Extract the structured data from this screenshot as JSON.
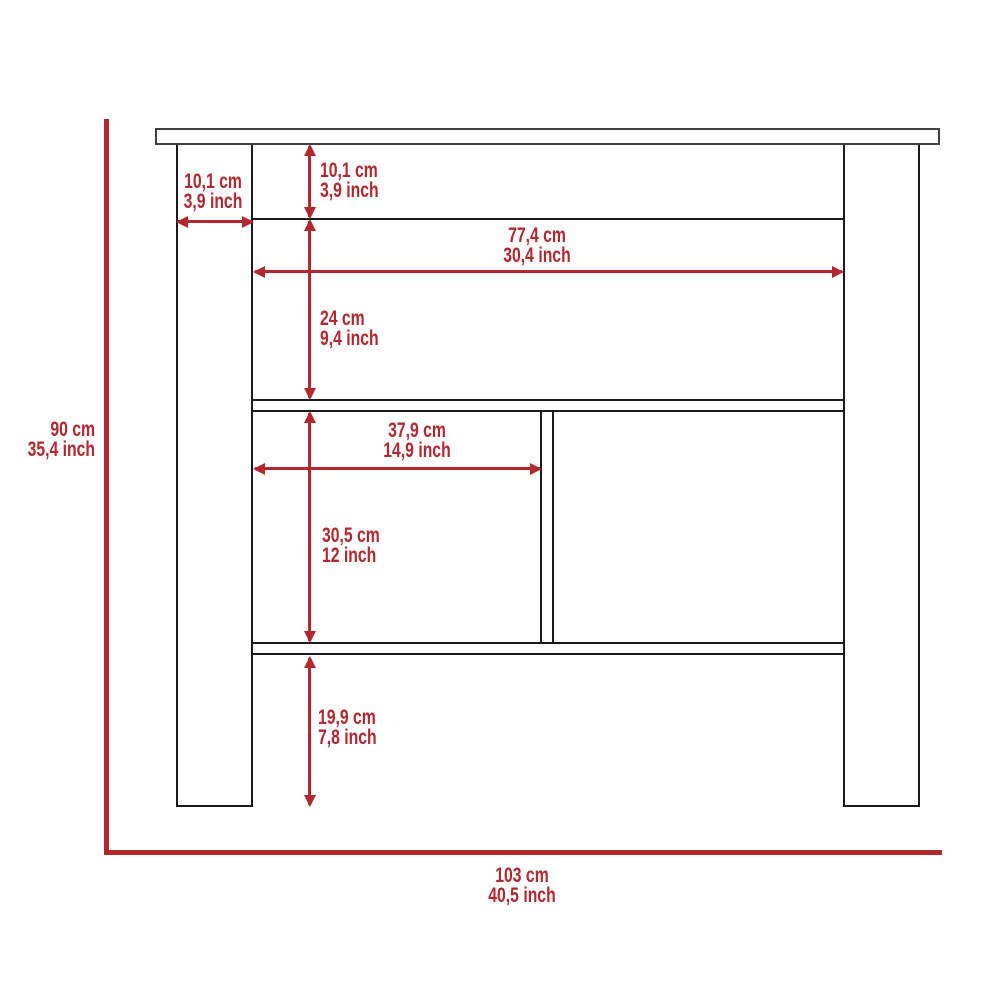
{
  "colors": {
    "dimension_red": "#b2282f",
    "line_black": "#1b1b1b",
    "top_gray": "#404040",
    "background": "#ffffff"
  },
  "dimensions": {
    "leg_width": {
      "cm": "10,1 cm",
      "inch": "3,9 inch"
    },
    "top_rail_height": {
      "cm": "10,1 cm",
      "inch": "3,9 inch"
    },
    "inner_width": {
      "cm": "77,4 cm",
      "inch": "30,4 inch"
    },
    "upper_compartment_height": {
      "cm": "24 cm",
      "inch": "9,4 inch"
    },
    "left_compartment_width": {
      "cm": "37,9 cm",
      "inch": "14,9 inch"
    },
    "lower_compartment_height": {
      "cm": "30,5 cm",
      "inch": "12 inch"
    },
    "bottom_clearance": {
      "cm": "19,9 cm",
      "inch": "7,8 inch"
    },
    "overall_height": {
      "cm": "90 cm",
      "inch": "35,4 inch"
    },
    "overall_width": {
      "cm": "103 cm",
      "inch": "40,5 inch"
    }
  }
}
